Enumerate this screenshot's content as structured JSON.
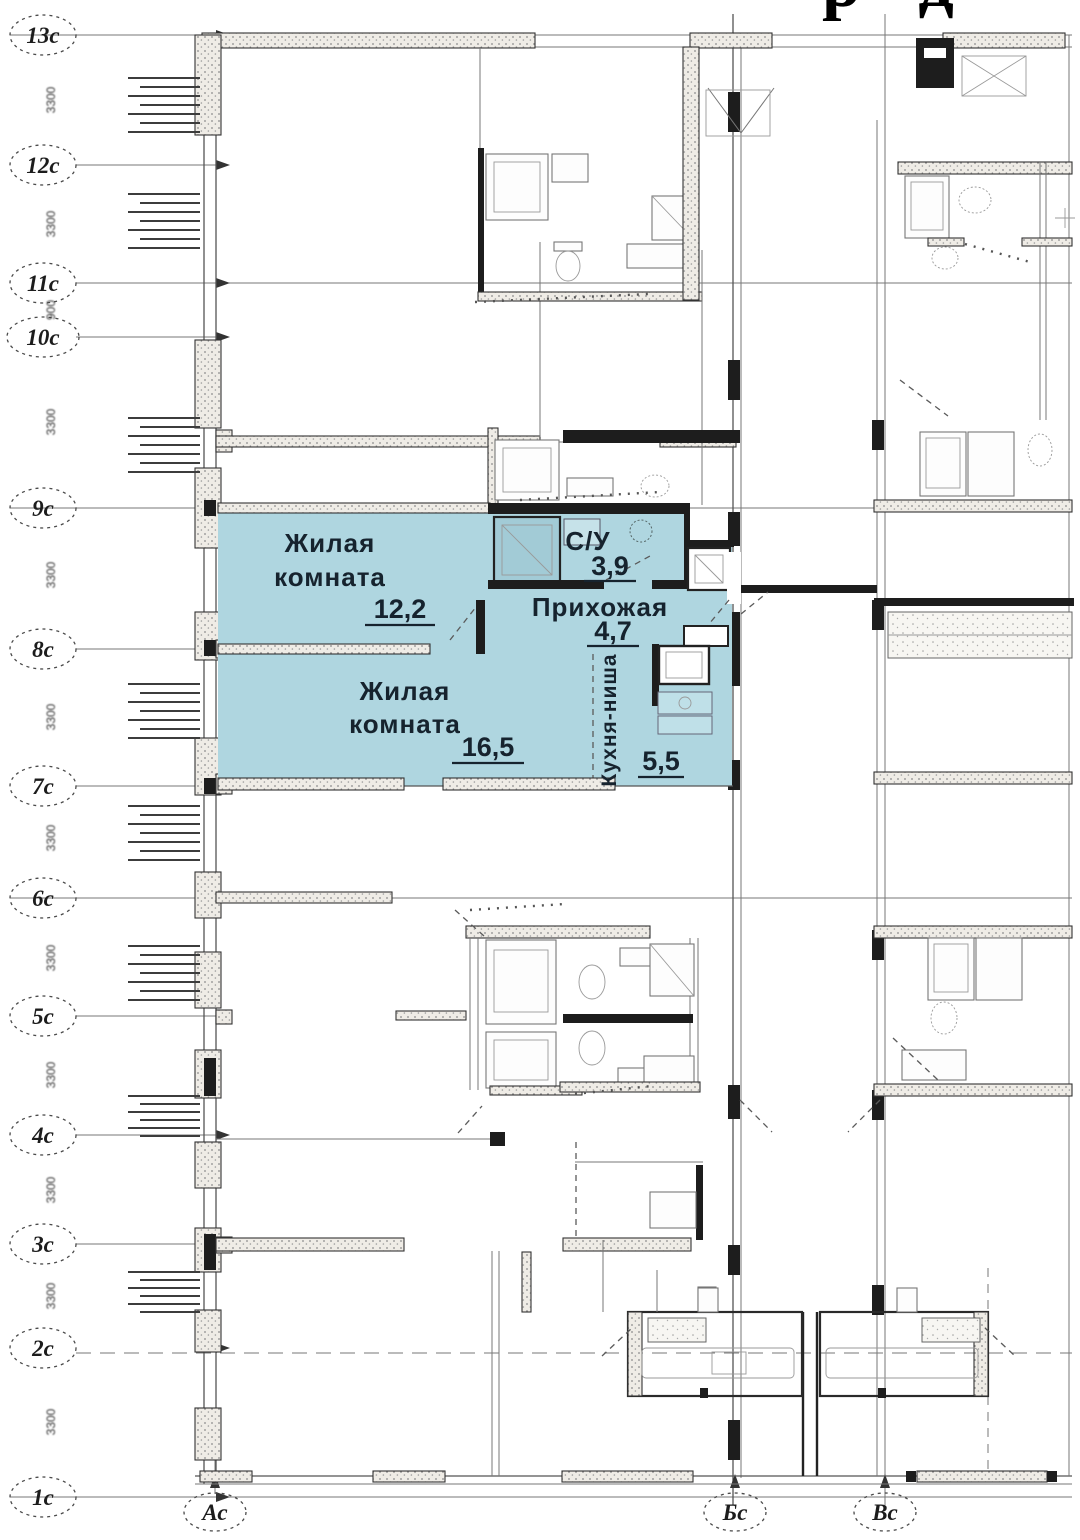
{
  "header": {
    "title_fragment": "р д"
  },
  "highlighted_apartment": {
    "fill": "#afd6e0",
    "rooms": [
      {
        "lines": [
          "Жилая",
          "комната"
        ],
        "area": "12,2"
      },
      {
        "name": "С/У",
        "area": "3,9"
      },
      {
        "name": "Прихожая",
        "area": "4,7"
      },
      {
        "lines": [
          "Жилая",
          "комната"
        ],
        "area": "16,5"
      },
      {
        "name": "Кухня-ниша",
        "area": "5,5"
      }
    ]
  },
  "axes": {
    "left": [
      "13с",
      "12с",
      "11с",
      "10с",
      "9с",
      "8с",
      "7с",
      "6с",
      "5с",
      "4с",
      "3с",
      "2с",
      "1с"
    ],
    "bottom": [
      "Ас",
      "Бс",
      "Вс"
    ],
    "dims": [
      "3300",
      "3300",
      "900",
      "3300",
      "3300",
      "3300",
      "3300",
      "3300",
      "3300",
      "3300",
      "3300",
      "3300"
    ]
  }
}
